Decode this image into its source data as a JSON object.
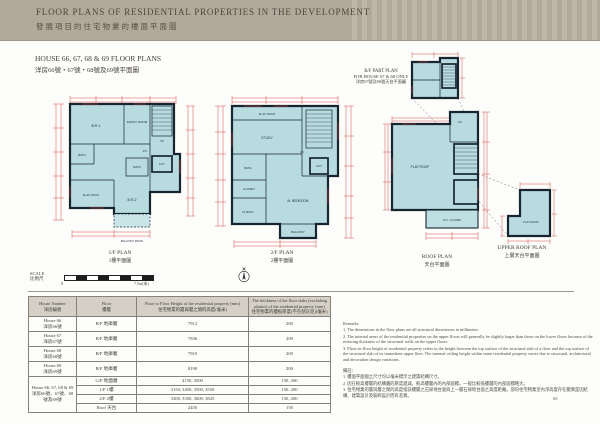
{
  "header": {
    "title_en": "FLOOR PLANS OF RESIDENTIAL PROPERTIES IN THE DEVELOPMENT",
    "title_zh": "發展項目的住宅物業的樓面平面圖"
  },
  "section": {
    "title_en": "HOUSE 66, 67, 68 & 69 FLOOR PLANS",
    "title_zh": "洋房66號・67號・68號及69號平面圖"
  },
  "plans": {
    "fp1": {
      "label_en": "1/F PLAN",
      "label_zh": "1樓平面圖",
      "rooms": {
        "br1": "B.R.1",
        "family_room": "FAMILY ROOM",
        "up": "UP",
        "lift": "LIFT",
        "bath": "BATH",
        "bath2": "BATH",
        "pd": "P.D.",
        "br2": "B.R.2",
        "flat_roof": "FLAT ROOF",
        "balcony_roof": "BALCONY ROOF"
      }
    },
    "fp2": {
      "label_en": "2/F PLAN",
      "label_zh": "2樓平面圖",
      "rooms": {
        "flat_roof": "FLAT ROOF",
        "study": "STUDY",
        "dn": "DN",
        "lift": "LIFT",
        "bath": "BATH",
        "closet": "CLOSET",
        "m_bath": "M. BATH",
        "m_bedroom": "M. BEDROOM",
        "balcony": "BALCONY"
      }
    },
    "rf_part": {
      "label_l1": "R/F PART PLAN",
      "label_l2": "FOR HOUSE 67 & 68 ONLY",
      "label_zh": "洋房67號及68號天台平面圖"
    },
    "roof": {
      "label_en": "ROOF PLAN",
      "label_zh": "天台平面圖",
      "rooms": {
        "flat_roof": "FLAT ROOF",
        "ac": "A/C",
        "rc_cover": "R.C. COVER"
      }
    },
    "upper_roof": {
      "label_en": "UPPER ROOF PLAN",
      "label_zh": "上層天台平面圖",
      "rooms": {
        "flat_roof": "FLAT ROOF"
      }
    }
  },
  "scale": {
    "label_en": "SCALE",
    "label_zh": "比例尺",
    "start": "0",
    "end": "7.5m(米)"
  },
  "table": {
    "headers": {
      "house_en": "House Number",
      "house_zh": "洋房編號",
      "floor_en": "Floor",
      "floor_zh": "樓層",
      "height_en": "Floor to Floor Height of the residential property (mm)",
      "height_zh": "住宅物業的層與層之間的高度(毫米)",
      "thick_en": "The thickness of the floor slabs (excluding plaster) of the residential property (mm)",
      "thick_zh": "住宅物業的樓板厚度(不包括灰泥)(毫米)"
    },
    "rows": [
      {
        "house_en": "House 66",
        "house_zh": "洋房66號",
        "floor": "B/F 地庫層",
        "height": "7912",
        "thickness": "200"
      },
      {
        "house_en": "House 67",
        "house_zh": "洋房67號",
        "floor": "B/F 地庫層",
        "height": "7836",
        "thickness": "200"
      },
      {
        "house_en": "House 68",
        "house_zh": "洋房68號",
        "floor": "B/F 地庫層",
        "height": "7910",
        "thickness": "200"
      },
      {
        "house_en": "House 69",
        "house_zh": "洋房69號",
        "floor": "B/F 地庫層",
        "height": "8190",
        "thickness": "200"
      }
    ],
    "group": {
      "house_en": "House 66, 67, 68 & 69",
      "house_zh": "洋房66號、67號、68號及69號",
      "subrows": [
        {
          "floor": "G/F 地面層",
          "height": "4150, 4500",
          "thickness": "150, 200"
        },
        {
          "floor": "1/F 1樓",
          "height": "3150, 3450, 3500, 3550",
          "thickness": "150, 200"
        },
        {
          "floor": "2/F 2樓",
          "height": "3300, 3350, 3600, 3825",
          "thickness": "150, 200"
        },
        {
          "floor": "Roof 天台",
          "height": "2450",
          "thickness": "150"
        }
      ]
    }
  },
  "remarks": {
    "title_en": "Remarks:",
    "en": [
      "1. The dimensions in the floor plans are all structural dimensions in millimeter.",
      "2. The internal areas of the residential properties on the upper floors will generally be slightly larger than those on the lower floors because of the reducing thickness of the structural walls on the upper floors.",
      "3. Floor-to-floor height of residential property refers to the height between the top surface of the structural slab of a floor and the top surface of the structural slab of its immediate upper floor. The internal ceiling height within some residential property varies due to structural, architectural and decoration design variations."
    ],
    "title_zh": "備註：",
    "zh": [
      "1. 樓面平面圖之尺寸均以毫米標示之建築結構尺寸。",
      "2. 因在較高樓層的結構牆的厚度遞減，較高樓層內的內部面積，一般比較低樓層的內部面積略大。",
      "3. 住宅物業的層與層之間的高度指該樓層之石屎地台面與上一層石屎地台面之高度距離。部份住宅物業室內淨高度存在變異是因結構、建築設計及裝飾設計而有差異。"
    ]
  },
  "page_number": "68"
}
